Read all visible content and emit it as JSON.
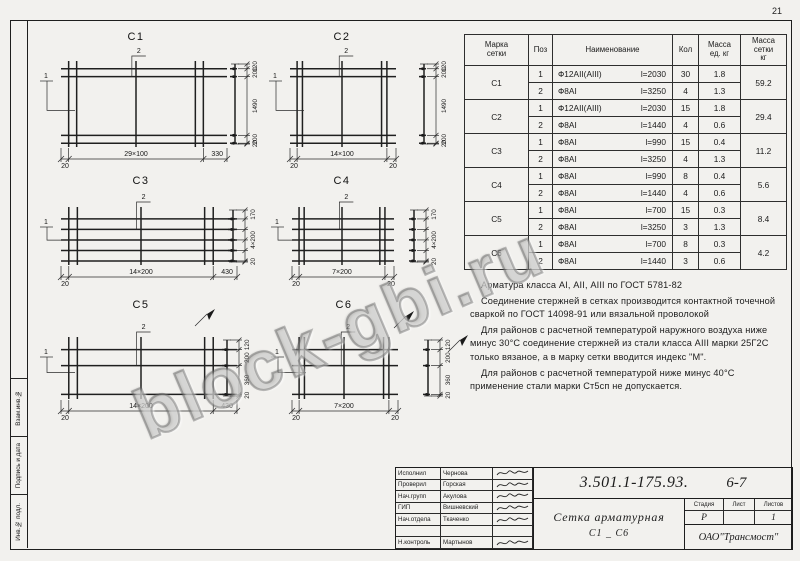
{
  "page": {
    "number": "21"
  },
  "watermark": "block-gbi.ru",
  "frame": {
    "side_labels": [
      "Взам.инв.№",
      "Подпись и дата",
      "Инв.№ подл."
    ]
  },
  "meshes": [
    {
      "title": "С1",
      "leader1": "1",
      "leader2": "2",
      "bottom_dims": [
        "20",
        "29×100",
        "330"
      ],
      "side_dims": [
        "120",
        "200",
        "1490",
        "200",
        "20"
      ]
    },
    {
      "title": "С2",
      "leader1": "1",
      "leader2": "2",
      "bottom_dims": [
        "20",
        "14×100",
        "20"
      ],
      "side_dims": [
        "120",
        "200",
        "1490",
        "200",
        "20"
      ]
    },
    {
      "title": "С3",
      "leader1": "1",
      "leader2": "2",
      "bottom_dims": [
        "20",
        "14×200",
        "430"
      ],
      "side_dims": [
        "170",
        "4×200",
        "20"
      ]
    },
    {
      "title": "С4",
      "leader1": "1",
      "leader2": "2",
      "bottom_dims": [
        "20",
        "7×200",
        "20"
      ],
      "side_dims": [
        "170",
        "4×200",
        "20"
      ]
    },
    {
      "title": "С5",
      "leader1": "1",
      "leader2": "2",
      "bottom_dims": [
        "20",
        "14×200",
        "430"
      ],
      "side_dims": [
        "120",
        "200",
        "360",
        "20"
      ]
    },
    {
      "title": "С6",
      "leader1": "1",
      "leader2": "2",
      "bottom_dims": [
        "20",
        "7×200",
        "20"
      ],
      "side_dims": [
        "120",
        "200",
        "360",
        "20"
      ]
    }
  ],
  "table": {
    "headers": [
      "Марка\nсетки",
      "Поз",
      "Наименование",
      "Кол",
      "Масса\nед. кг",
      "Масса\nсетки\nкг"
    ],
    "groups": [
      {
        "mark": "С1",
        "rows": [
          [
            "1",
            "Ф12АII(АIII)",
            "l=2030",
            "30",
            "1.8"
          ],
          [
            "2",
            "Ф8АI",
            "l=3250",
            "4",
            "1.3"
          ]
        ],
        "mass": "59.2"
      },
      {
        "mark": "С2",
        "rows": [
          [
            "1",
            "Ф12АII(АIII)",
            "l=2030",
            "15",
            "1.8"
          ],
          [
            "2",
            "Ф8АI",
            "l=1440",
            "4",
            "0.6"
          ]
        ],
        "mass": "29.4"
      },
      {
        "mark": "С3",
        "rows": [
          [
            "1",
            "Ф8АI",
            "l=990",
            "15",
            "0.4"
          ],
          [
            "2",
            "Ф8АI",
            "l=3250",
            "4",
            "1.3"
          ]
        ],
        "mass": "11.2"
      },
      {
        "mark": "С4",
        "rows": [
          [
            "1",
            "Ф8АI",
            "l=990",
            "8",
            "0.4"
          ],
          [
            "2",
            "Ф8АI",
            "l=1440",
            "4",
            "0.6"
          ]
        ],
        "mass": "5.6"
      },
      {
        "mark": "С5",
        "rows": [
          [
            "1",
            "Ф8АI",
            "l=700",
            "15",
            "0.3"
          ],
          [
            "2",
            "Ф8АI",
            "l=3250",
            "3",
            "1.3"
          ]
        ],
        "mass": "8.4"
      },
      {
        "mark": "С6",
        "rows": [
          [
            "1",
            "Ф8АI",
            "l=700",
            "8",
            "0.3"
          ],
          [
            "2",
            "Ф8АI",
            "l=1440",
            "3",
            "0.6"
          ]
        ],
        "mass": "4.2"
      }
    ]
  },
  "notes": [
    "Арматура класса АI, АII, АIII по ГОСТ 5781-82",
    "Соединение стержней в сетках производится контактной точечной сваркой по ГОСТ 14098-91 или вязальной проволокой",
    "Для районов с расчетной температурой наружного воздуха ниже минус 30°С соединение стержней из стали класса АIII марки 25Г2С только вязаное, а в марку сетки вводится индекс \"М\".",
    "Для районов с расчетной температурой ниже минус 40°С применение стали марки Ст5сп не допускается."
  ],
  "title_block": {
    "doc_number": "3.501.1-175.93.",
    "sheet_range": "6-7",
    "title_line1": "Сетка арматурная",
    "title_line2": "С1 _ С6",
    "org": "ОАО\"Трансмост\"",
    "stage_headers": [
      "Стадия",
      "Лист",
      "Листов"
    ],
    "stage": "Р",
    "sheet": "",
    "sheets_total": "1",
    "signature_rows": [
      {
        "role": "Исполнил",
        "name": "Чернова"
      },
      {
        "role": "Проверил",
        "name": "Горская"
      },
      {
        "role": "Нач.групп",
        "name": "Акулова"
      },
      {
        "role": "ГИП",
        "name": "Вишневский"
      },
      {
        "role": "Нач.отдела",
        "name": "Ткаченко"
      },
      {
        "role": "",
        "name": ""
      },
      {
        "role": "Н.контроль",
        "name": "Мартынов"
      }
    ]
  }
}
